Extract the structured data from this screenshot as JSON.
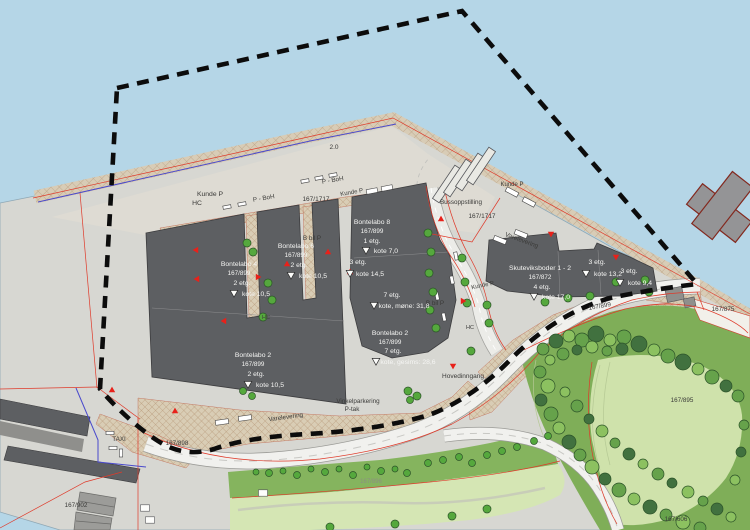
{
  "map": {
    "palette": {
      "water": "#b5d6e7",
      "land": "#d7d7d2",
      "apron": "#dedbd3",
      "building": "#5d5f62",
      "road": "#f1f1ee",
      "boundary": "#0c0c0c",
      "red_line": "#df3a2a",
      "blue_line": "#4a4acc",
      "label_dark": "#3a3a38",
      "label_light": "#f5f5f3",
      "label_faint": "#8d8d85",
      "entrance_marker": "#e8211a",
      "tree_fills": [
        "#41713f",
        "#66a24b",
        "#8cc160",
        "#55a83d"
      ],
      "tree_stroke": "#2c5329"
    },
    "labels": [
      {
        "text": "Kunde P",
        "x": 210,
        "y": 196,
        "size": 6.8,
        "color": "dark"
      },
      {
        "text": "HC",
        "x": 197,
        "y": 205,
        "size": 6.8,
        "color": "dark"
      },
      {
        "text": "P - BoH",
        "x": 264,
        "y": 200,
        "size": 6.3,
        "color": "dark",
        "angle": -10
      },
      {
        "text": "P - BoH",
        "x": 333,
        "y": 182,
        "size": 6.3,
        "color": "dark",
        "angle": -10
      },
      {
        "text": "167/1717",
        "x": 316,
        "y": 201,
        "size": 6.5,
        "color": "dark"
      },
      {
        "text": "167/1717",
        "x": 482,
        "y": 218,
        "size": 6.5,
        "color": "dark"
      },
      {
        "text": "Bussoppstilling",
        "x": 461,
        "y": 204,
        "size": 6.3,
        "color": "dark"
      },
      {
        "text": "Kunde P",
        "x": 352,
        "y": 194,
        "size": 6,
        "color": "dark",
        "angle": -10
      },
      {
        "text": "Kunde P",
        "x": 512,
        "y": 186,
        "size": 6,
        "color": "dark"
      },
      {
        "text": "Varelevering",
        "x": 521,
        "y": 242,
        "size": 6.3,
        "color": "dark",
        "angle": 20
      },
      {
        "text": "2.0",
        "x": 334,
        "y": 149,
        "size": 6.5,
        "color": "dark"
      },
      {
        "text": "B bil P",
        "x": 312,
        "y": 240,
        "size": 6.3,
        "color": "dark"
      },
      {
        "text": "B bil P",
        "x": 435,
        "y": 305,
        "size": 6.3,
        "color": "dark"
      },
      {
        "text": "HC",
        "x": 266,
        "y": 319,
        "size": 5.5,
        "color": "dark"
      },
      {
        "text": "HC",
        "x": 470,
        "y": 329,
        "size": 5.5,
        "color": "dark"
      },
      {
        "text": "Kunde P",
        "x": 483,
        "y": 287,
        "size": 6,
        "color": "dark",
        "angle": -12
      },
      {
        "text": "Hovedinngang",
        "x": 463,
        "y": 378,
        "size": 6.5,
        "color": "dark"
      },
      {
        "text": "167/899",
        "x": 600,
        "y": 308,
        "size": 6.3,
        "color": "dark",
        "angle": -10
      },
      {
        "text": "167/875",
        "x": 723,
        "y": 311,
        "size": 6.3,
        "color": "dark"
      },
      {
        "text": "167/895",
        "x": 682,
        "y": 402,
        "size": 6.3,
        "color": "dark"
      },
      {
        "text": "167/606",
        "x": 676,
        "y": 521,
        "size": 6.3,
        "color": "dark"
      },
      {
        "text": "167/902",
        "x": 76,
        "y": 507,
        "size": 6.3,
        "color": "dark"
      },
      {
        "text": "TAXI",
        "x": 119,
        "y": 441,
        "size": 6.3,
        "color": "dark"
      },
      {
        "text": "167/898",
        "x": 177,
        "y": 445,
        "size": 6.3,
        "color": "dark"
      },
      {
        "text": "Varelevering",
        "x": 286,
        "y": 419,
        "size": 6.3,
        "color": "dark",
        "angle": -8
      },
      {
        "text": "Vinkelparkering",
        "x": 358,
        "y": 403,
        "size": 6.3,
        "color": "dark"
      },
      {
        "text": "P-tak",
        "x": 352,
        "y": 411,
        "size": 6.3,
        "color": "dark"
      },
      {
        "text": "167/896",
        "x": 371,
        "y": 483,
        "size": 6,
        "color": "faint"
      },
      {
        "text": "Bontelabo 4",
        "x": 239,
        "y": 266,
        "size": 6.8,
        "color": "light"
      },
      {
        "text": "167/899",
        "x": 239,
        "y": 275,
        "size": 6.3,
        "color": "light"
      },
      {
        "text": "2 etg.",
        "x": 242,
        "y": 285,
        "size": 6.8,
        "color": "light"
      },
      {
        "text": "kote 10,5",
        "x": 256,
        "y": 296,
        "size": 6.8,
        "color": "light"
      },
      {
        "text": "Bontelabo 6",
        "x": 296,
        "y": 248,
        "size": 6.8,
        "color": "light"
      },
      {
        "text": "167/899",
        "x": 296,
        "y": 257,
        "size": 6.3,
        "color": "light"
      },
      {
        "text": "2 etg.",
        "x": 299,
        "y": 267,
        "size": 6.8,
        "color": "light"
      },
      {
        "text": "kote 10,5",
        "x": 313,
        "y": 278,
        "size": 6.8,
        "color": "light"
      },
      {
        "text": "Bontelabo 8",
        "x": 372,
        "y": 224,
        "size": 6.8,
        "color": "light"
      },
      {
        "text": "167/899",
        "x": 372,
        "y": 233,
        "size": 6.3,
        "color": "light"
      },
      {
        "text": "1 etg.",
        "x": 372,
        "y": 243,
        "size": 6.8,
        "color": "light"
      },
      {
        "text": "kote 7,0",
        "x": 386,
        "y": 253,
        "size": 6.8,
        "color": "light"
      },
      {
        "text": "3 etg.",
        "x": 358,
        "y": 264,
        "size": 6.8,
        "color": "light"
      },
      {
        "text": "kote 14,5",
        "x": 370,
        "y": 276,
        "size": 6.8,
        "color": "light"
      },
      {
        "text": "7 etg.",
        "x": 392,
        "y": 297,
        "size": 6.8,
        "color": "light"
      },
      {
        "text": "kote, møne: 31,8",
        "x": 404,
        "y": 308,
        "size": 6.8,
        "color": "light"
      },
      {
        "text": "Bontelabo 2",
        "x": 390,
        "y": 335,
        "size": 6.8,
        "color": "light"
      },
      {
        "text": "167/899",
        "x": 390,
        "y": 344,
        "size": 6.3,
        "color": "light"
      },
      {
        "text": "7 etg.",
        "x": 393,
        "y": 353,
        "size": 6.8,
        "color": "light"
      },
      {
        "text": "kote, gesims: 28,6",
        "x": 408,
        "y": 364,
        "size": 6.8,
        "color": "light"
      },
      {
        "text": "Bontelabo 2",
        "x": 253,
        "y": 357,
        "size": 6.8,
        "color": "light"
      },
      {
        "text": "167/899",
        "x": 253,
        "y": 366,
        "size": 6.3,
        "color": "light"
      },
      {
        "text": "2 etg.",
        "x": 256,
        "y": 376,
        "size": 6.8,
        "color": "light"
      },
      {
        "text": "kote 10,5",
        "x": 270,
        "y": 387,
        "size": 6.8,
        "color": "light"
      },
      {
        "text": "Skuteviksboder 1 - 2",
        "x": 540,
        "y": 270,
        "size": 6.8,
        "color": "light"
      },
      {
        "text": "167/872",
        "x": 540,
        "y": 279,
        "size": 6.3,
        "color": "light"
      },
      {
        "text": "4 etg.",
        "x": 542,
        "y": 289,
        "size": 6.8,
        "color": "light"
      },
      {
        "text": "kote 17,0",
        "x": 556,
        "y": 299,
        "size": 6.8,
        "color": "light"
      },
      {
        "text": "3 etg.",
        "x": 597,
        "y": 264,
        "size": 6.8,
        "color": "light"
      },
      {
        "text": "kote 13,2",
        "x": 608,
        "y": 276,
        "size": 6.8,
        "color": "light"
      },
      {
        "text": "3 etg.",
        "x": 629,
        "y": 273,
        "size": 6.8,
        "color": "light"
      },
      {
        "text": "kote 9,4",
        "x": 640,
        "y": 285,
        "size": 6.8,
        "color": "light"
      }
    ],
    "kote_markers": [
      [
        234,
        293
      ],
      [
        291,
        275
      ],
      [
        366,
        250
      ],
      [
        350,
        273
      ],
      [
        374,
        305
      ],
      [
        376,
        361
      ],
      [
        248,
        384
      ],
      [
        534,
        296
      ],
      [
        586,
        273
      ],
      [
        620,
        282
      ]
    ],
    "entrance_markers": [
      [
        196,
        250,
        90
      ],
      [
        197,
        279,
        90
      ],
      [
        224,
        321,
        90
      ],
      [
        258,
        277,
        -90
      ],
      [
        287,
        264,
        180
      ],
      [
        328,
        252,
        180
      ],
      [
        350,
        272,
        180
      ],
      [
        441,
        219,
        180
      ],
      [
        453,
        366,
        0
      ],
      [
        551,
        234,
        0
      ],
      [
        616,
        257,
        0
      ],
      [
        112,
        390,
        180
      ],
      [
        175,
        411,
        180
      ],
      [
        463,
        301,
        -90
      ]
    ],
    "trees": [
      [
        247,
        243,
        4
      ],
      [
        253,
        252,
        4
      ],
      [
        268,
        283,
        4
      ],
      [
        272,
        300,
        4
      ],
      [
        263,
        317,
        4
      ],
      [
        428,
        233,
        4
      ],
      [
        431,
        252,
        4
      ],
      [
        429,
        273,
        4
      ],
      [
        433,
        292,
        4
      ],
      [
        430,
        310,
        4
      ],
      [
        436,
        328,
        4
      ],
      [
        462,
        258,
        4
      ],
      [
        465,
        282,
        4
      ],
      [
        467,
        303,
        4
      ],
      [
        487,
        305,
        4
      ],
      [
        545,
        302,
        4
      ],
      [
        568,
        298,
        4
      ],
      [
        590,
        296,
        4
      ],
      [
        616,
        282,
        4
      ],
      [
        645,
        280,
        4
      ],
      [
        649,
        292,
        4
      ],
      [
        489,
        323,
        4
      ],
      [
        471,
        351,
        4
      ],
      [
        408,
        391,
        4
      ],
      [
        417,
        396,
        4
      ],
      [
        410,
        400,
        3.5
      ],
      [
        243,
        391,
        3.5
      ],
      [
        252,
        396,
        3.5
      ],
      [
        256,
        472,
        3
      ],
      [
        269,
        473,
        3.5
      ],
      [
        283,
        471,
        3
      ],
      [
        297,
        475,
        3.5
      ],
      [
        311,
        469,
        3
      ],
      [
        325,
        472,
        3.5
      ],
      [
        339,
        469,
        3
      ],
      [
        353,
        475,
        3.5
      ],
      [
        367,
        467,
        3
      ],
      [
        381,
        471,
        3.5
      ],
      [
        395,
        469,
        3
      ],
      [
        407,
        473,
        3.5
      ],
      [
        428,
        463,
        3.5
      ],
      [
        443,
        460,
        3.5
      ],
      [
        459,
        457,
        3.5
      ],
      [
        472,
        463,
        3.5
      ],
      [
        487,
        455,
        3.5
      ],
      [
        502,
        451,
        3.5
      ],
      [
        517,
        447,
        3.5
      ],
      [
        534,
        441,
        3.5
      ],
      [
        548,
        436,
        3.5
      ],
      [
        330,
        527,
        4
      ],
      [
        395,
        524,
        4
      ],
      [
        452,
        516,
        4
      ],
      [
        487,
        509,
        4
      ],
      [
        543,
        349,
        6,
        1
      ],
      [
        556,
        341,
        7,
        0
      ],
      [
        569,
        336,
        6,
        2
      ],
      [
        582,
        340,
        7,
        1
      ],
      [
        596,
        334,
        8,
        0
      ],
      [
        610,
        340,
        6,
        2
      ],
      [
        624,
        337,
        7,
        1
      ],
      [
        639,
        344,
        8,
        0
      ],
      [
        654,
        350,
        6,
        2
      ],
      [
        668,
        356,
        7,
        1
      ],
      [
        683,
        362,
        8,
        0
      ],
      [
        698,
        369,
        6,
        2
      ],
      [
        712,
        377,
        7,
        1
      ],
      [
        726,
        386,
        6,
        0
      ],
      [
        738,
        396,
        6,
        1
      ],
      [
        550,
        360,
        5,
        2
      ],
      [
        563,
        354,
        6,
        1
      ],
      [
        577,
        350,
        5,
        0
      ],
      [
        592,
        347,
        6,
        2
      ],
      [
        607,
        351,
        5,
        1
      ],
      [
        622,
        349,
        6,
        0
      ],
      [
        540,
        372,
        6,
        1
      ],
      [
        548,
        386,
        7,
        2
      ],
      [
        541,
        400,
        6,
        0
      ],
      [
        551,
        414,
        7,
        1
      ],
      [
        559,
        428,
        6,
        2
      ],
      [
        569,
        442,
        7,
        0
      ],
      [
        580,
        455,
        6,
        1
      ],
      [
        592,
        467,
        7,
        2
      ],
      [
        605,
        479,
        6,
        0
      ],
      [
        619,
        490,
        7,
        1
      ],
      [
        634,
        499,
        6,
        2
      ],
      [
        650,
        507,
        7,
        0
      ],
      [
        666,
        515,
        6,
        1
      ],
      [
        683,
        522,
        7,
        2
      ],
      [
        700,
        528,
        6,
        1
      ],
      [
        565,
        392,
        5,
        2
      ],
      [
        577,
        406,
        6,
        1
      ],
      [
        589,
        419,
        5,
        0
      ],
      [
        602,
        431,
        6,
        2
      ],
      [
        615,
        443,
        5,
        1
      ],
      [
        629,
        454,
        6,
        0
      ],
      [
        643,
        464,
        5,
        2
      ],
      [
        658,
        474,
        6,
        1
      ],
      [
        672,
        483,
        5,
        0
      ],
      [
        688,
        492,
        6,
        2
      ],
      [
        703,
        501,
        5,
        1
      ],
      [
        717,
        509,
        6,
        0
      ],
      [
        731,
        517,
        5,
        2
      ],
      [
        744,
        425,
        5,
        1
      ],
      [
        741,
        452,
        5,
        0
      ],
      [
        735,
        480,
        5,
        2
      ]
    ],
    "vehicles": [
      [
        227,
        207,
        -11,
        8
      ],
      [
        242,
        204,
        -11,
        8
      ],
      [
        305,
        181,
        -11,
        8
      ],
      [
        319,
        178,
        -11,
        8
      ],
      [
        333,
        175,
        -11,
        8
      ],
      [
        372,
        191,
        -11,
        11
      ],
      [
        387,
        188,
        -11,
        11
      ],
      [
        512,
        192,
        28,
        13
      ],
      [
        529,
        202,
        28,
        13
      ],
      [
        500,
        240,
        22,
        13
      ],
      [
        521,
        234,
        22,
        13
      ],
      [
        222,
        422,
        -8,
        13
      ],
      [
        245,
        418,
        -8,
        13
      ],
      [
        110,
        433,
        0,
        8
      ],
      [
        113,
        448,
        0,
        8
      ],
      [
        121,
        453,
        90,
        8
      ],
      [
        452,
        280,
        78,
        8
      ],
      [
        437,
        296,
        78,
        8
      ],
      [
        444,
        317,
        78,
        8
      ],
      [
        456,
        256,
        78,
        8
      ]
    ],
    "bus_bays": [
      [
        447,
        184
      ],
      [
        458,
        178
      ],
      [
        470,
        172
      ],
      [
        481,
        166
      ]
    ],
    "sheds": [
      [
        145,
        508
      ],
      [
        150,
        520
      ],
      [
        263,
        493
      ]
    ]
  }
}
